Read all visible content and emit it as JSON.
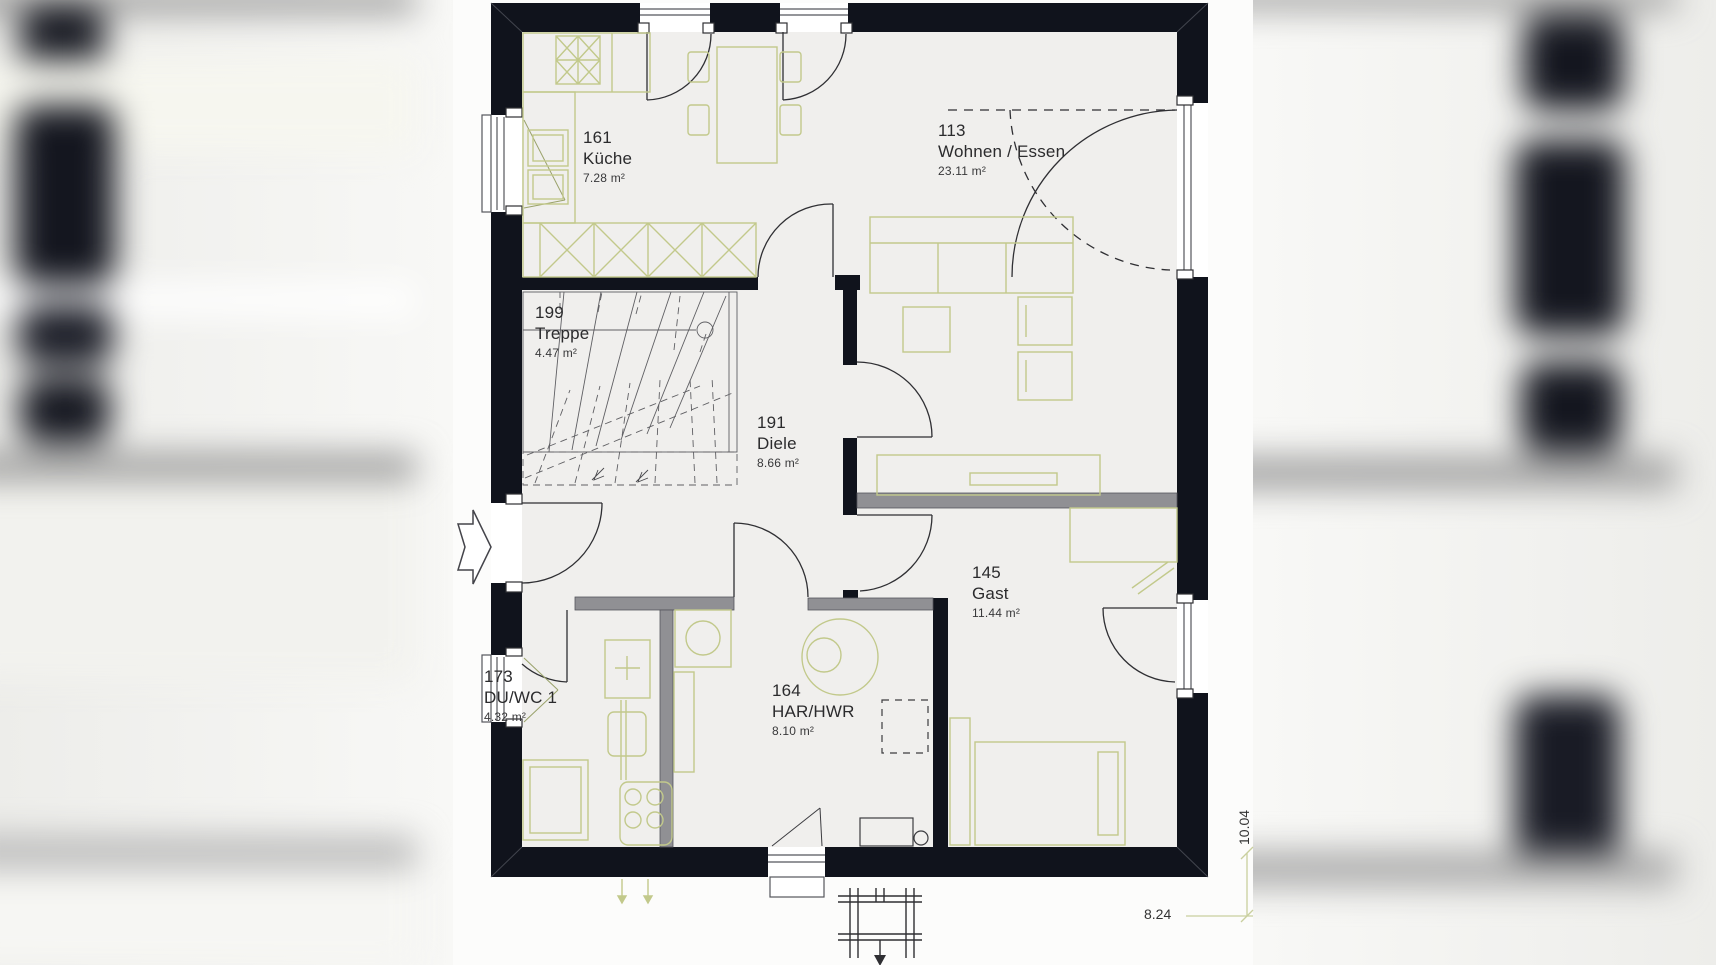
{
  "document": {
    "type": "floor-plan",
    "floor": "ground-floor"
  },
  "rooms": [
    {
      "id": "kueche",
      "number": "161",
      "name": "Küche",
      "area": "7.28 m²"
    },
    {
      "id": "wohnen",
      "number": "113",
      "name": "Wohnen / Essen",
      "area": "23.11 m²"
    },
    {
      "id": "treppe",
      "number": "199",
      "name": "Treppe",
      "area": "4.47 m²"
    },
    {
      "id": "diele",
      "number": "191",
      "name": "Diele",
      "area": "8.66 m²"
    },
    {
      "id": "gast",
      "number": "145",
      "name": "Gast",
      "area": "11.44 m²"
    },
    {
      "id": "duwc",
      "number": "173",
      "name": "DU/WC 1",
      "area": "4.32 m²"
    },
    {
      "id": "har",
      "number": "164",
      "name": "HAR/HWR",
      "area": "8.10 m²"
    }
  ],
  "dimensions": {
    "overall_depth": "10.04",
    "overall_width": "8.24"
  },
  "colors": {
    "wall": "#10131c",
    "interior_wall": "#909094",
    "furniture_line": "#c2c98b",
    "floor": "#f0efed",
    "thin_line": "#2f2f33",
    "dimension_line": "#c9cf9e"
  },
  "icons": {
    "entrance_arrow": "arrow-right"
  }
}
